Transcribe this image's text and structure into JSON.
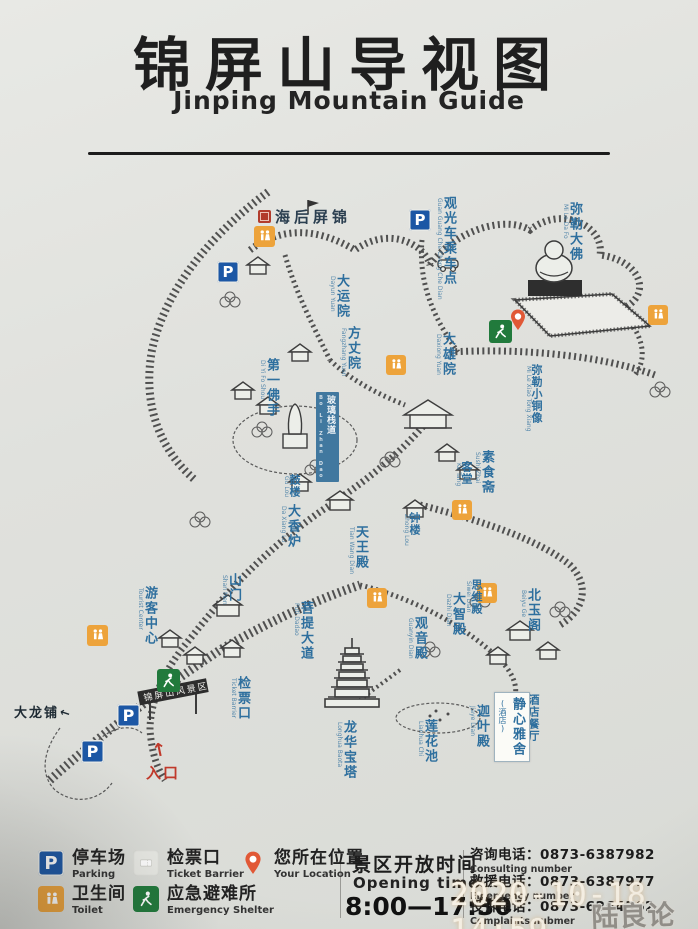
{
  "title": {
    "zh": "锦屏山导视图",
    "en": "Jinping Mountain Guide"
  },
  "map": {
    "houhai_calligraphy": "锦屏后海",
    "gate_sign": "锦屏山风景区",
    "entrance": {
      "label": "入口",
      "arrow": "↑"
    },
    "dalongpu": {
      "label": "大龙铺",
      "arrow": "←"
    },
    "labels": [
      {
        "zh": "观光车乘车点",
        "sub": "Guan Guang Che Cheng Che Dian"
      },
      {
        "zh": "弥勒大佛",
        "sub": "Mi Le Da Fo"
      },
      {
        "zh": "大运院",
        "sub": "Dayun Yuan"
      },
      {
        "zh": "方丈院",
        "sub": "Fangzhang Yuan"
      },
      {
        "zh": "第一佛手",
        "sub": "Di Yi Fo Shou"
      },
      {
        "zh": "大雄院",
        "sub": "Daxiong Yuan"
      },
      {
        "zh": "弥勒小铜像",
        "sub": "Mi Le Xiao Tong Xiang"
      },
      {
        "zh": "玻璃栈道",
        "sub": "Bo Li Zhan Dao"
      },
      {
        "zh": "素食斋",
        "sub": "Sushi Zhai"
      },
      {
        "zh": "客堂",
        "sub": "Ke Tang"
      },
      {
        "zh": "鼓楼",
        "sub": "Gu Lou"
      },
      {
        "zh": "大香炉",
        "sub": "Da Xiang Lu"
      },
      {
        "zh": "天王殿",
        "sub": "Tian Wang Dian"
      },
      {
        "zh": "钟楼",
        "sub": "Zhong Lou"
      },
      {
        "zh": "思维殿",
        "sub": "Siwei Dian"
      },
      {
        "zh": "大智殿",
        "sub": "Dazhi Dian"
      },
      {
        "zh": "北玉阁",
        "sub": "Beiyu Ge"
      },
      {
        "zh": "观音殿",
        "sub": "Guanyin Dian"
      },
      {
        "zh": "山门",
        "sub": "Shan Men"
      },
      {
        "zh": "游客中心",
        "sub": "Tourist Center"
      },
      {
        "zh": "菩提大道",
        "sub": "Puti Dadao"
      },
      {
        "zh": "检票口",
        "sub": "Ticket Barrier"
      },
      {
        "zh": "酒店餐厅",
        "sub": "Jiudian Canting"
      },
      {
        "zh": "迦叶殿",
        "sub": "Jiaye Dian"
      },
      {
        "zh": "莲花池",
        "sub": "Lianhua Chi"
      },
      {
        "zh": "龙华宝塔",
        "sub": "Longhua Baota"
      }
    ],
    "boxed_label": {
      "zh": "静心雅舍",
      "sub": "(酒店)"
    },
    "icon_glossary": {
      "parking-icon": "P",
      "toilet-icon": "male/female figures",
      "emergency-shelter-icon": "running figure",
      "location-pin-icon": "teardrop pin"
    },
    "colors": {
      "label_blue": "#2e6f9e",
      "parking_blue": "#1c57a5",
      "toilet_orange": "#eda33b",
      "shelter_green": "#217a3c",
      "pin_red": "#e15836",
      "entrance_red": "#c0392b"
    }
  },
  "legend": {
    "items": [
      {
        "icon": "parking",
        "zh": "停车场",
        "en": "Parking"
      },
      {
        "icon": "toilet",
        "zh": "卫生间",
        "en": "Toilet"
      },
      {
        "icon": "ticket",
        "zh": "检票口",
        "en": "Ticket Barrier"
      },
      {
        "icon": "shelter",
        "zh": "应急避难所",
        "en": "Emergency Shelter"
      },
      {
        "icon": "pin",
        "zh": "您所在位置",
        "en": "Your Location"
      }
    ]
  },
  "opening": {
    "zh": "景区开放时间",
    "en": "Opening time",
    "hours": "8:00—17:30"
  },
  "contacts": [
    {
      "zh": "咨询电话：0873-6387982",
      "en": "Consulting number"
    },
    {
      "zh": "救援电话：0873-6387977",
      "en": "Emergency number"
    },
    {
      "zh": "投诉电话：0873-6264362",
      "en": "Complaints nubmer"
    }
  ],
  "watermark": {
    "timestamp": "2020-10-18 14:59",
    "forum": "陆良论坛"
  }
}
